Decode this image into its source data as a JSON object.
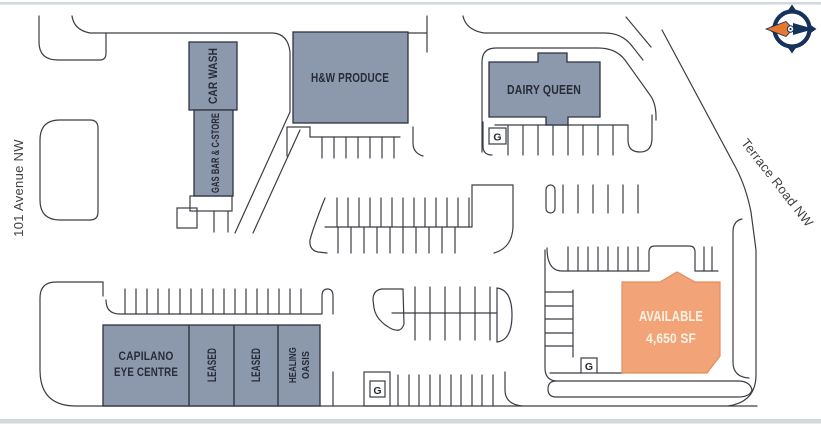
{
  "streets": {
    "left_label": "101 Avenue NW",
    "right_label": "Terrace Road NW"
  },
  "tenants": {
    "car_wash": "CAR WASH",
    "gas_bar": "GAS BAR & C-STORE",
    "hw_produce": "H&W PRODUCE",
    "dairy_queen": "DAIRY QUEEN",
    "capilano_line1": "CAPILANO",
    "capilano_line2": "EYE CENTRE",
    "leased_1": "LEASED",
    "leased_2": "LEASED",
    "healing_line1": "HEALING",
    "healing_line2": "OASIS",
    "available_line1": "AVAILABLE",
    "available_line2": "4,650 SF"
  },
  "markers": {
    "g1": "G",
    "g2": "G",
    "g3": "G"
  },
  "colors": {
    "building_fill": "#8C99AC",
    "building_stroke": "#2E3340",
    "available_fill": "#F2A478",
    "available_stroke": "#E09059",
    "available_label_color": "#FBF3E4",
    "label_color": "#262B36",
    "street_label_color": "#3F4145",
    "line": "#3A3D44",
    "page_edge": "#D3D8DD",
    "logo_navy": "#16325B",
    "logo_orange": "#E8772E"
  }
}
